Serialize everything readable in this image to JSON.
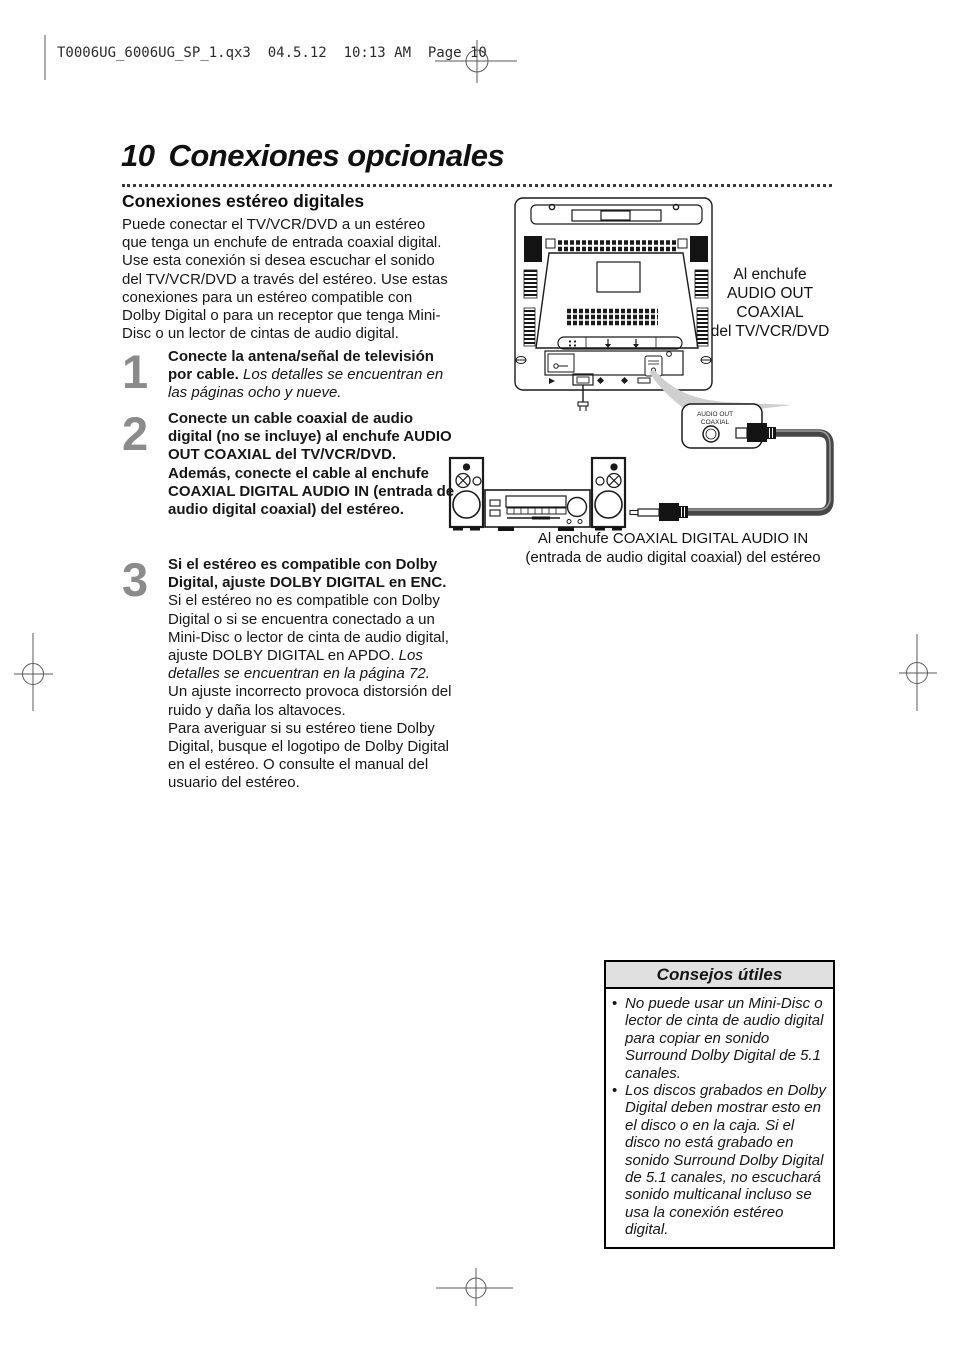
{
  "print_header": "T0006UG_6006UG_SP_1.qx3  04.5.12  10:13 AM  Page 10",
  "title": {
    "number": "10",
    "text": "Conexiones opcionales"
  },
  "section": {
    "heading": "Conexiones estéreo digitales",
    "intro": "Puede conectar el TV/VCR/DVD a un estéreo que tenga un enchufe de entrada coaxial digital. Use esta conexión si desea escuchar el sonido del TV/VCR/DVD a través del estéreo. Use estas conexiones para un estéreo compatible con Dolby Digital o para un receptor que tenga Mini-Disc o un lector de cintas de audio digital."
  },
  "steps": [
    {
      "number": "1",
      "bold": "Conecte la antena/señal de televisión por cable.",
      "italic": "Los detalles se encuentran en las páginas ocho y nueve."
    },
    {
      "number": "2",
      "bold": "Conecte un cable coaxial de audio digital (no se incluye) al enchufe AUDIO OUT COAXIAL del TV/VCR/DVD.",
      "bold2": "Además, conecte el cable al enchufe COAXIAL DIGITAL AUDIO IN (entrada de audio digital coaxial) del estéreo."
    },
    {
      "number": "3",
      "bold": "Si el estéreo es compatible con Dolby Digital, ajuste DOLBY DIGITAL en ENC.",
      "normal": "Si el estéreo no es compatible con Dolby Digital o si se encuentra conectado a un Mini-Disc o lector de cinta de audio digital, ajuste DOLBY DIGITAL en APDO.",
      "italic": "Los detalles se encuentran en la página 72.",
      "normal2": "Un ajuste incorrecto provoca distorsión del ruido y daña los altavoces.",
      "normal3": "Para averiguar si su estéreo tiene Dolby Digital, busque el logotipo de Dolby Digital en el estéreo. O consulte el manual del usuario del estéreo."
    }
  ],
  "diagram": {
    "tv_callout": {
      "line1": "Al enchufe",
      "line2": "AUDIO OUT",
      "line3": "COAXIAL",
      "line4": "del TV/VCR/DVD"
    },
    "jack_label": {
      "line1": "AUDIO OUT",
      "line2": "COAXIAL"
    },
    "stereo_caption": {
      "line1": "Al enchufe COAXIAL DIGITAL AUDIO IN",
      "line2": "(entrada de audio digital coaxial) del estéreo"
    }
  },
  "tips_box": {
    "title": "Consejos útiles",
    "bullet": "•",
    "items": [
      "No puede usar un Mini-Disc o lector de cinta de audio digital para copiar en sonido Surround Dolby Digital de 5.1 canales.",
      "Los discos grabados en Dolby Digital deben mostrar esto en el disco o en la caja. Si el disco no está grabado en sonido Surround Dolby Digital de 5.1 canales, no escuchará sonido multicanal incluso se usa la conexión estéreo digital."
    ]
  },
  "colors": {
    "text": "#161616",
    "step_number": "#8b8b8b",
    "tips_header_bg": "#e0e0e0",
    "cable": "#474747",
    "callout_wedge": "#cfcfcf"
  }
}
